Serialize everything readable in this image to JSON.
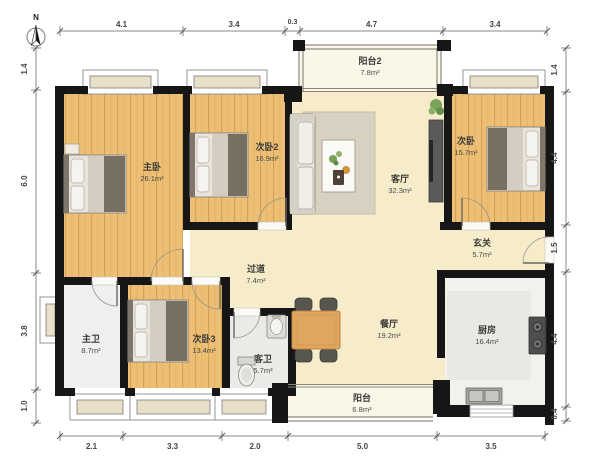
{
  "compass": {
    "north_label": "N"
  },
  "rooms": {
    "master_bedroom": {
      "name": "主卧",
      "area": "26.1m²"
    },
    "bedroom2": {
      "name": "次卧2",
      "area": "16.9m²"
    },
    "bedroom": {
      "name": "次卧",
      "area": "15.7m²"
    },
    "bedroom3": {
      "name": "次卧3",
      "area": "13.4m²"
    },
    "living_room": {
      "name": "客厅",
      "area": "32.3m²"
    },
    "dining_room": {
      "name": "餐厅",
      "area": "19.2m²"
    },
    "hallway": {
      "name": "过道",
      "area": "7.4m²"
    },
    "entry": {
      "name": "玄关",
      "area": "5.7m²"
    },
    "master_bath": {
      "name": "主卫",
      "area": "8.7m²"
    },
    "guest_bath": {
      "name": "客卫",
      "area": "5.7m²"
    },
    "kitchen": {
      "name": "厨房",
      "area": "16.4m²"
    },
    "balcony2": {
      "name": "阳台2",
      "area": "7.8m²"
    },
    "balcony": {
      "name": "阳台",
      "area": "6.8m²"
    }
  },
  "dimensions": {
    "top": [
      "4.1",
      "3.4",
      "0.3",
      "4.7",
      "3.4"
    ],
    "bottom": [
      "2.1",
      "3.3",
      "2.0",
      "5.0",
      "3.5"
    ],
    "left": [
      "1.4",
      "6.0",
      "3.8",
      "1.0"
    ],
    "right": [
      "1.4",
      "4.4",
      "1.5",
      "4.4",
      "0.4"
    ]
  },
  "colors": {
    "wall": "#161616",
    "wood_floor": "#ecbf74",
    "tile_cream": "#f6ecca",
    "bath_floor": "#edeff1",
    "kitchen_floor": "#f2f1ec",
    "balcony_floor": "#faf6e8"
  }
}
